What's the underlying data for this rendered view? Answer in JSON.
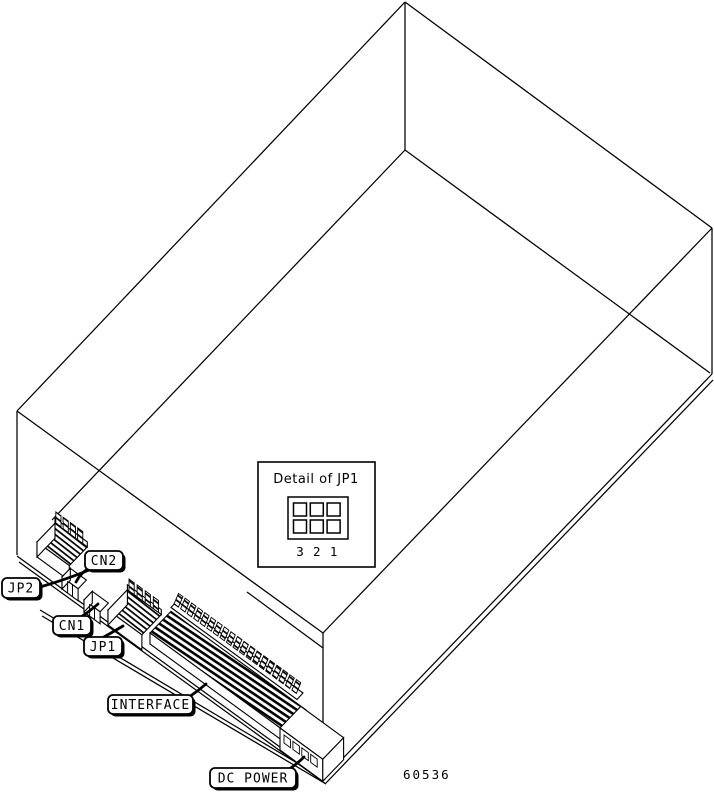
{
  "figure": {
    "labels": {
      "jp2": "JP2",
      "cn2": "CN2",
      "cn1": "CN1",
      "jp1": "JP1",
      "interface": "INTERFACE",
      "dc_power": "DC POWER"
    },
    "inset": {
      "title": "Detail of JP1",
      "pin_numbers": [
        "3",
        "2",
        "1"
      ]
    },
    "part_number": "60536",
    "colors": {
      "line": "#000000",
      "background": "#ffffff"
    }
  }
}
